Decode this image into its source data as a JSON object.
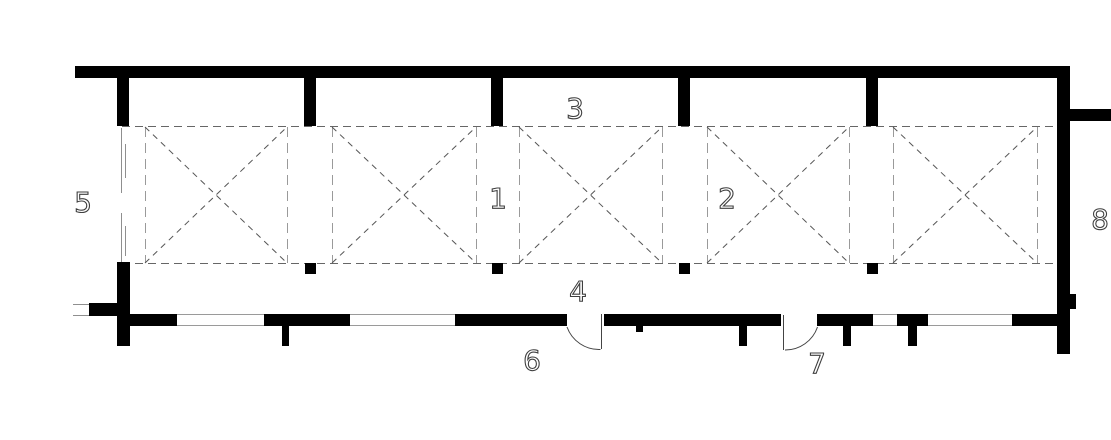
{
  "drawing": {
    "kind": "architectural floor plan",
    "labels": {
      "l1": "1",
      "l2": "2",
      "l3": "3",
      "l4": "4",
      "l5": "5",
      "l6": "6",
      "l7": "7",
      "l8": "8"
    },
    "counts": {
      "crossed_boxes": 5,
      "door_swings": 2,
      "top_piers": 5,
      "window_openings": 4
    },
    "colors": {
      "wall": "#000000",
      "grid_dash": "#666666",
      "box_edge_dash": "#9a9a9a",
      "diagonal_dash": "#555555",
      "window_line": "#9a9a9a",
      "door_line": "#444444",
      "label": "#3f3f3f",
      "background": "#ffffff"
    }
  }
}
